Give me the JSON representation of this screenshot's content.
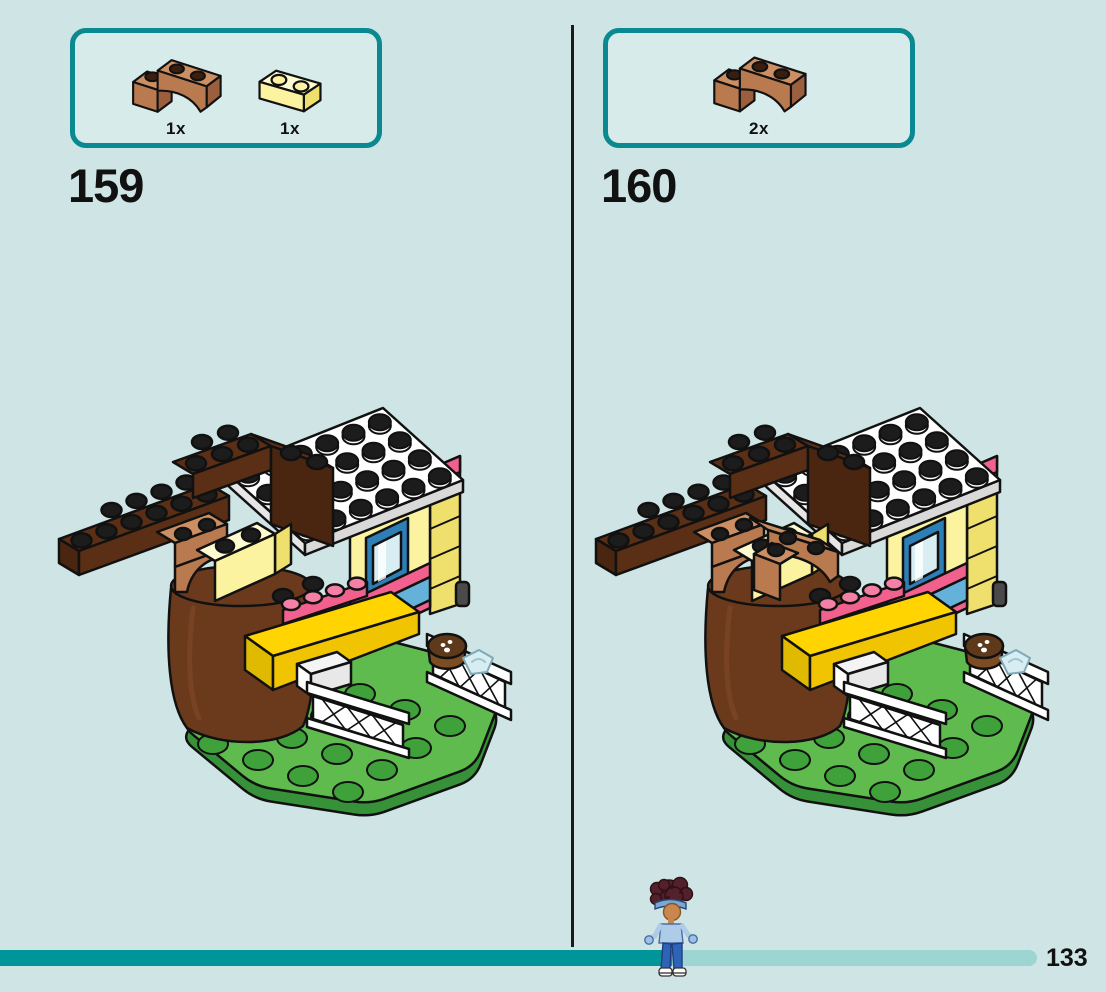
{
  "steps": [
    {
      "number": "159",
      "illustration": "lego-treehouse-model",
      "parts": [
        {
          "icon": "brown-arch-brick-icon",
          "count": "1x"
        },
        {
          "icon": "yellow-brick-icon",
          "count": "1x"
        }
      ]
    },
    {
      "number": "160",
      "illustration": "lego-treehouse-model-with-arches",
      "parts": [
        {
          "icon": "brown-arch-brick-icon",
          "count": "2x"
        }
      ]
    }
  ],
  "footer": {
    "page_number": "133",
    "progress_fraction": 0.648
  },
  "colors": {
    "background": "#cfe4e4",
    "panel_background": "#d7ebea",
    "panel_border": "#0a8a90",
    "divider": "#1a1a1a",
    "progress_fill": "#009598",
    "progress_track": "#9cd5d2",
    "text": "#111111",
    "lego": {
      "dark_brown": "#5a2f16",
      "dark_brown_shade": "#4a250f",
      "trunk_brown": "#6b3a1d",
      "nougat": "#b97a50",
      "nougat_light": "#cb8f63",
      "pale_yellow": "#fbf3a0",
      "pale_yellow_side": "#efe06e",
      "pale_yellow_top": "#fffbd0",
      "bright_yellow": "#ffd400",
      "pink": "#f2618e",
      "green_top": "#5fbb4e",
      "green_stud": "#3fa13a",
      "green_side": "#379138",
      "blue_window": "#2d7fb5",
      "blue_light": "#64b1d9",
      "white": "#ffffff",
      "stud_black": "#1c1c1c"
    }
  }
}
